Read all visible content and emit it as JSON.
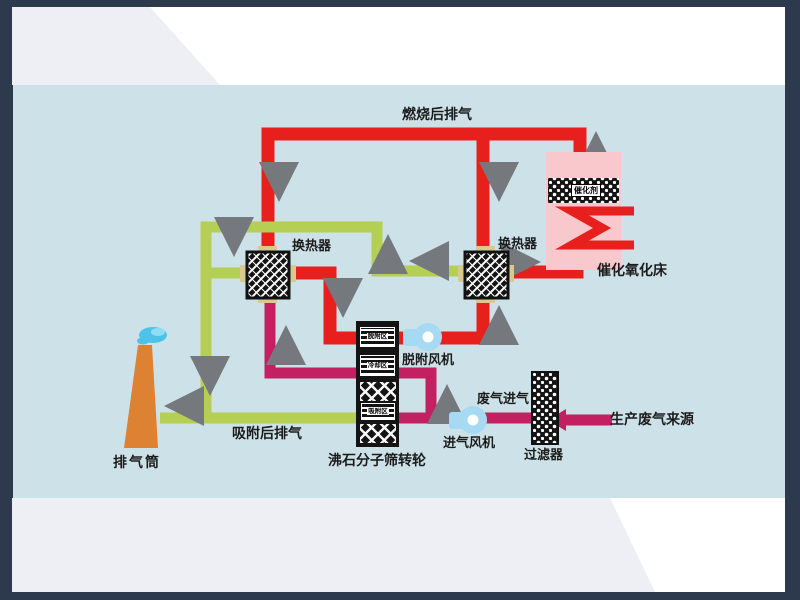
{
  "diagram": {
    "top_pipe_label": "燃烧后排气",
    "heat_exchanger_left_label": "换热器",
    "heat_exchanger_right_label": "换热器",
    "catalytic_bed_label": "催化氧化床",
    "catalyst_label": "催化剂",
    "desorption_fan_label": "脱附风机",
    "rotor_label": "沸石分子筛转轮",
    "rotor_zone_desorption": "脱附区",
    "rotor_zone_cooling": "冷却区",
    "rotor_zone_adsorption": "吸附区",
    "stack_label": "排气筒",
    "after_adsorption_label": "吸附后排气",
    "intake_fan_label": "进气风机",
    "filter_label": "过滤器",
    "waste_inlet_label": "废气进气",
    "source_label": "生产废气来源"
  },
  "colors": {
    "frame": "#2d3a4d",
    "band": "#edeff4",
    "panel": "#cde2e8",
    "pipe-hot": "#e8201d",
    "pipe-clean": "#b4cf53",
    "pipe-waste": "#c32061",
    "stack": "#dd8133",
    "bed": "#f8c8cd",
    "arrow": "#75797e",
    "fan": "#a5daf2"
  }
}
